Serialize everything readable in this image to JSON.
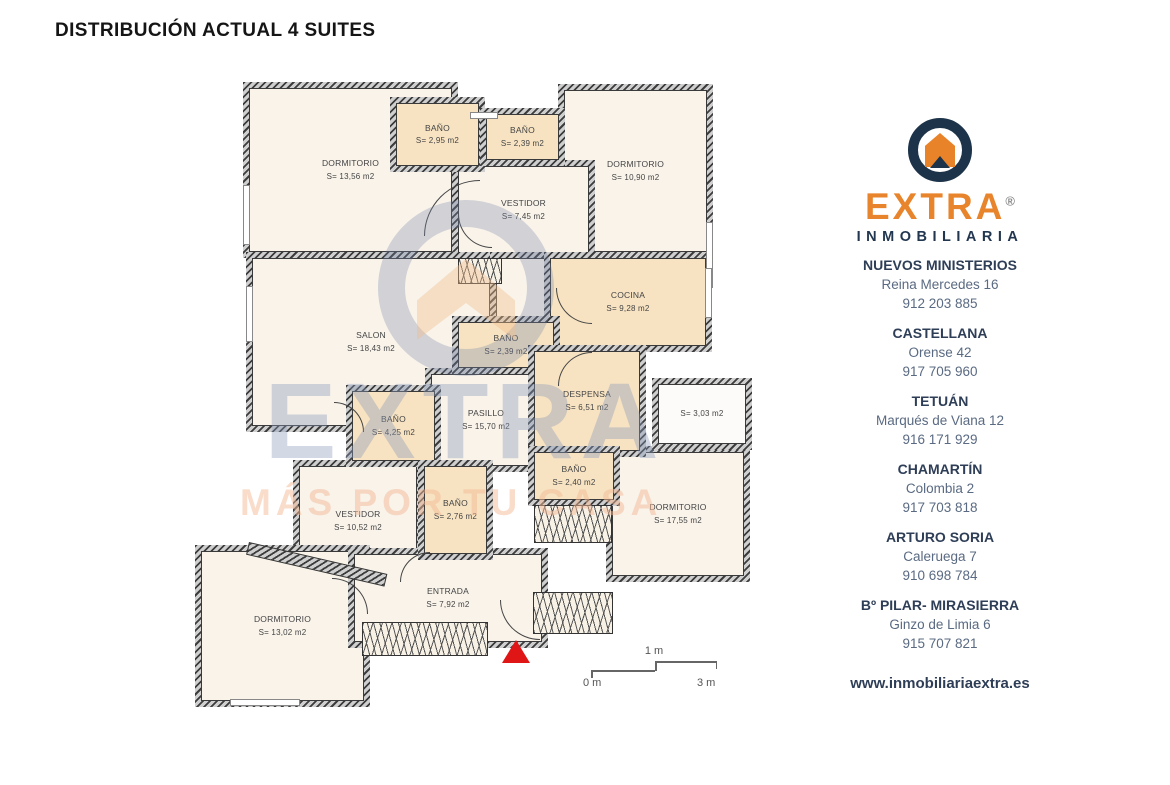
{
  "title": "DISTRIBUCIÓN ACTUAL 4 SUITES",
  "plan": {
    "rooms": [
      {
        "name": "DORMITORIO",
        "area": "S= 13,56 m2"
      },
      {
        "name": "BAÑO",
        "area": "S= 2,95 m2"
      },
      {
        "name": "BAÑO",
        "area": "S= 2,39 m2"
      },
      {
        "name": "DORMITORIO",
        "area": "S= 10,90 m2"
      },
      {
        "name": "VESTIDOR",
        "area": "S= 7,45 m2"
      },
      {
        "name": "SALON",
        "area": "S= 18,43 m2"
      },
      {
        "name": "COCINA",
        "area": "S= 9,28 m2"
      },
      {
        "name": "BAÑO",
        "area": "S= 2,39 m2"
      },
      {
        "name": "DESPENSA",
        "area": "S= 6,51 m2"
      },
      {
        "name": "PASILLO",
        "area": "S= 15,70 m2"
      },
      {
        "name": "",
        "area": "S= 3,03 m2"
      },
      {
        "name": "BAÑO",
        "area": "S= 4,25 m2"
      },
      {
        "name": "BAÑO",
        "area": "S= 2,76 m2"
      },
      {
        "name": "VESTIDOR",
        "area": "S= 10,52 m2"
      },
      {
        "name": "BAÑO",
        "area": "S= 2,40 m2"
      },
      {
        "name": "DORMITORIO",
        "area": "S= 17,55 m2"
      },
      {
        "name": "DORMITORIO",
        "area": "S= 13,02 m2"
      },
      {
        "name": "ENTRADA",
        "area": "S= 7,92 m2"
      }
    ],
    "scale": {
      "mid": "1 m",
      "start": "0 m",
      "end": "3 m"
    }
  },
  "watermark": {
    "brand": "EXTRA",
    "slogan": "MÁS POR TU CASA"
  },
  "sidebar": {
    "brand": "EXTRA",
    "registered": "®",
    "subtitle": "INMOBILIARIA",
    "offices": [
      {
        "name": "NUEVOS MINISTERIOS",
        "address": "Reina Mercedes 16",
        "phone": "912 203 885"
      },
      {
        "name": "CASTELLANA",
        "address": "Orense 42",
        "phone": "917 705 960"
      },
      {
        "name": "TETUÁN",
        "address": "Marqués de Viana 12",
        "phone": "916 171 929"
      },
      {
        "name": "CHAMARTÍN",
        "address": "Colombia 2",
        "phone": "917 703 818"
      },
      {
        "name": "ARTURO SORIA",
        "address": "Caleruega 7",
        "phone": "910 698 784"
      },
      {
        "name": "Bº PILAR- MIRASIERRA",
        "address": "Ginzo de Limia 6",
        "phone": "915 707 821"
      }
    ],
    "website": "www.inmobiliariaextra.es"
  },
  "colors": {
    "accent_orange": "#E8832A",
    "navy": "#1D3349",
    "room_beige": "#F7E3C2",
    "room_cream": "#F9F3EA",
    "wall_gray": "#3D3D3D",
    "marker_red": "#E01515"
  }
}
